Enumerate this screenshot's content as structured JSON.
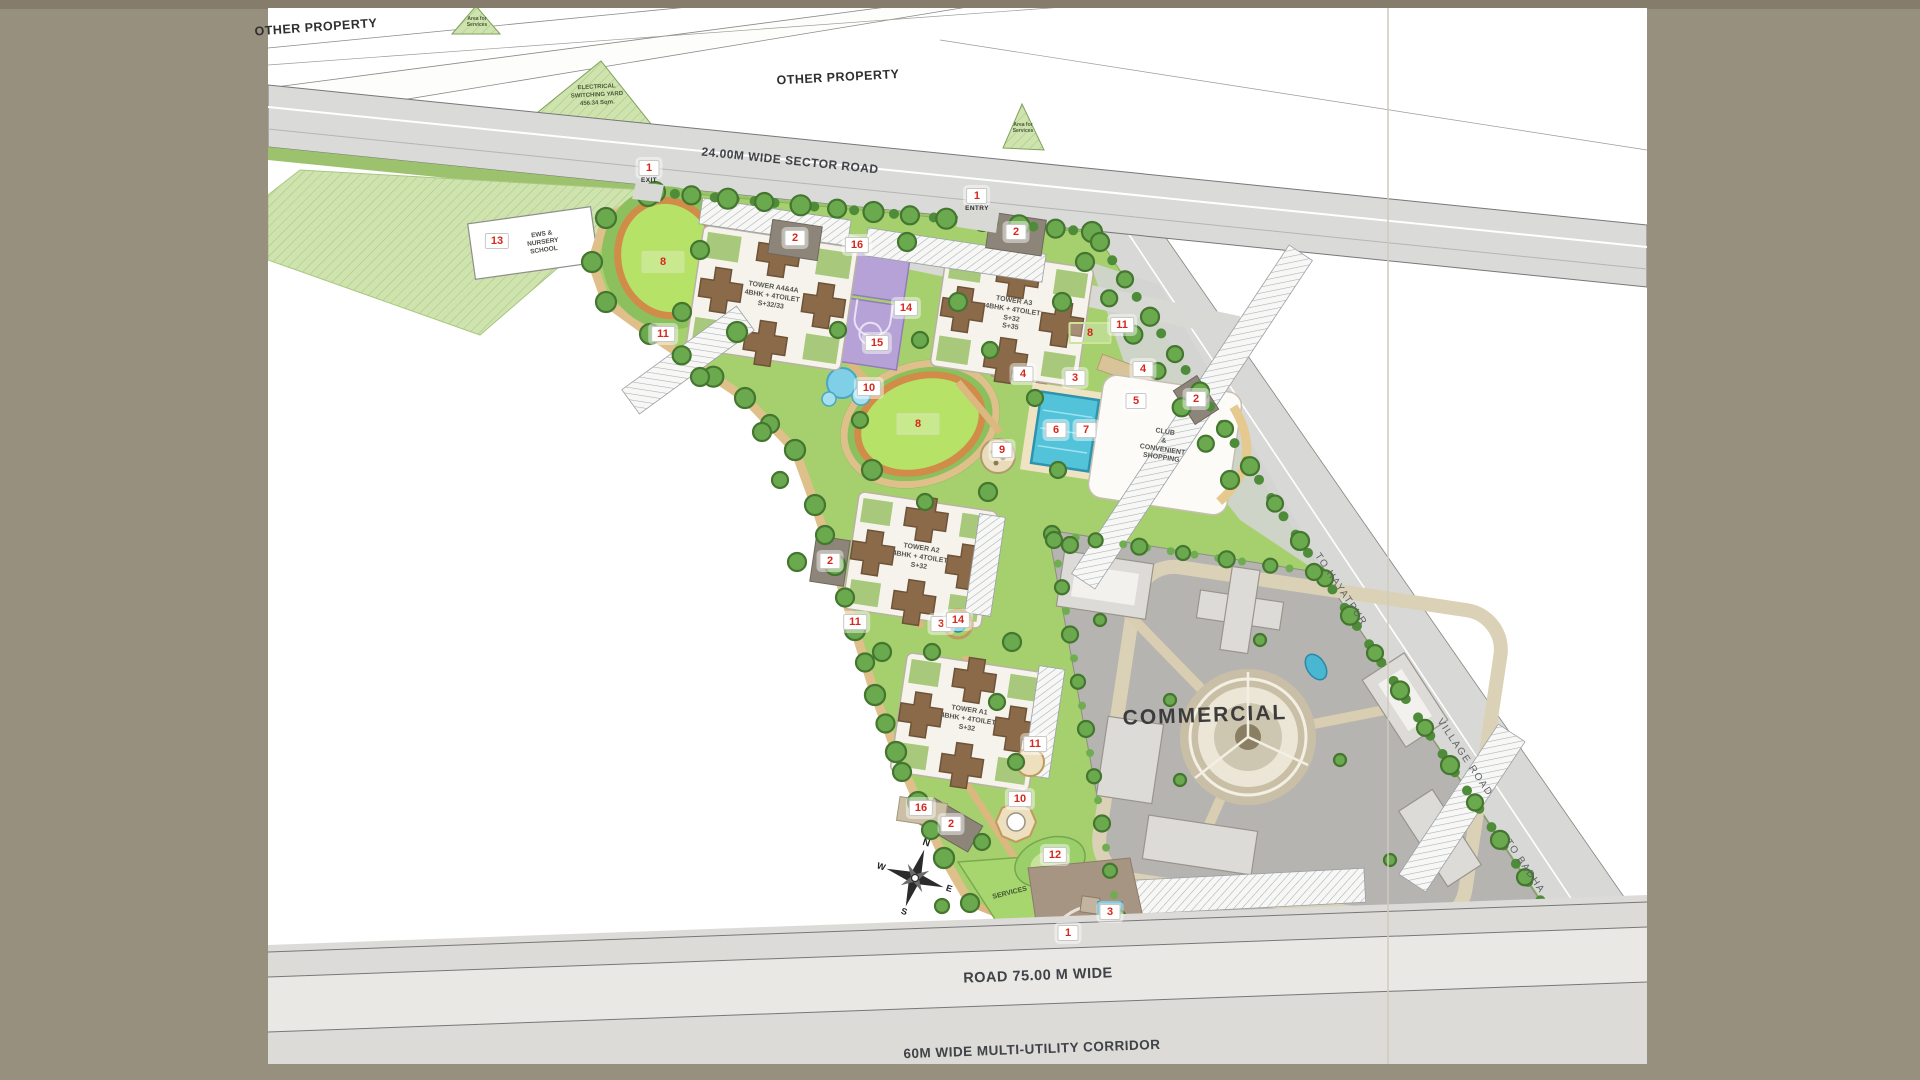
{
  "plan": {
    "labels": {
      "other_property_top": "OTHER PROPERTY",
      "other_property_mid": "OTHER PROPERTY",
      "sector_road": "24.00M WIDE SECTOR ROAD",
      "electrical_yard": "ELECTRICAL\nSWITCHING YARD\n456.34 Sqm.",
      "area_for_services_top": "Area for\nServices",
      "area_for_services_mid": "Area for\nServices",
      "school": "EWS &\nNURSERY\nSCHOOL",
      "club": "CLUB\n&\nCONVENIENT\nSHOPPING",
      "commercial": "COMMERCIAL",
      "services": "SERVICES",
      "road_75": "ROAD  75.00 M WIDE",
      "corridor": "60M WIDE MULTI-UTILITY CORRIDOR",
      "to_hayatpur": "TO HAYATPUR",
      "village_road": "VILLAGE ROAD",
      "to_badha": "TO BADHA"
    },
    "towers": {
      "a4": "TOWER A4&4A\n4BHK + 4TOILET\nS+32/33",
      "a3": "TOWER A3\n4BHK + 4TOILET\nS+32\nS+35",
      "a2": "TOWER A2\n4BHK + 4TOILET\nS+32",
      "a1": "TOWER A1\n4BHK + 4TOILET\nS+32"
    },
    "compass": {
      "n": "N",
      "e": "E",
      "s": "S",
      "w": "W"
    },
    "markers": [
      {
        "num": "1",
        "x": 649,
        "y": 172,
        "sub": "EXIT"
      },
      {
        "num": "1",
        "x": 977,
        "y": 200,
        "sub": "ENTRY"
      },
      {
        "num": "1",
        "x": 1068,
        "y": 933
      },
      {
        "num": "2",
        "x": 795,
        "y": 238
      },
      {
        "num": "2",
        "x": 1016,
        "y": 232
      },
      {
        "num": "2",
        "x": 1196,
        "y": 399
      },
      {
        "num": "2",
        "x": 830,
        "y": 561
      },
      {
        "num": "2",
        "x": 951,
        "y": 824
      },
      {
        "num": "3",
        "x": 1075,
        "y": 378
      },
      {
        "num": "3",
        "x": 941,
        "y": 624
      },
      {
        "num": "3",
        "x": 1110,
        "y": 912
      },
      {
        "num": "4",
        "x": 1023,
        "y": 374
      },
      {
        "num": "4",
        "x": 1143,
        "y": 369
      },
      {
        "num": "5",
        "x": 1136,
        "y": 401
      },
      {
        "num": "6",
        "x": 1056,
        "y": 430
      },
      {
        "num": "7",
        "x": 1086,
        "y": 430
      },
      {
        "num": "8",
        "x": 663,
        "y": 262,
        "style": "green"
      },
      {
        "num": "8",
        "x": 918,
        "y": 424,
        "style": "green"
      },
      {
        "num": "8",
        "x": 1090,
        "y": 333,
        "style": "green"
      },
      {
        "num": "9",
        "x": 1002,
        "y": 450
      },
      {
        "num": "10",
        "x": 869,
        "y": 388
      },
      {
        "num": "10",
        "x": 1020,
        "y": 799
      },
      {
        "num": "11",
        "x": 663,
        "y": 334
      },
      {
        "num": "11",
        "x": 1122,
        "y": 325
      },
      {
        "num": "11",
        "x": 855,
        "y": 622
      },
      {
        "num": "11",
        "x": 1035,
        "y": 744
      },
      {
        "num": "12",
        "x": 1055,
        "y": 855
      },
      {
        "num": "13",
        "x": 497,
        "y": 241
      },
      {
        "num": "14",
        "x": 906,
        "y": 308
      },
      {
        "num": "14",
        "x": 958,
        "y": 620
      },
      {
        "num": "15",
        "x": 877,
        "y": 343
      },
      {
        "num": "16",
        "x": 857,
        "y": 245
      },
      {
        "num": "16",
        "x": 921,
        "y": 808
      }
    ],
    "colors": {
      "mat": "#97907f",
      "sheet": "#ffffff",
      "road_gray": "#dadad8",
      "lawn": "#a6d06e",
      "lawn_bright": "#b7e268",
      "track_orange": "#d08c48",
      "water": "#53c3da",
      "court_purple": "#b7a2d8",
      "hedge_green": "#4e8c3a",
      "commercial_gray": "#b6b4b0",
      "path_tan": "#e0c08a",
      "marker_red": "#d6281e"
    }
  }
}
